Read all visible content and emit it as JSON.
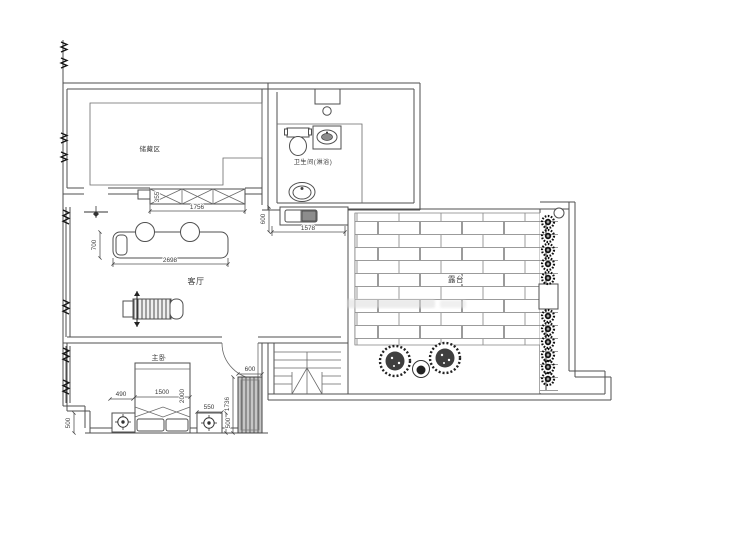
{
  "rooms": {
    "storage": "储藏区",
    "bathroom": "卫生间(淋浴)",
    "living_room": "客厅",
    "terrace": "露台",
    "master_bedroom": "主卧"
  },
  "dims": {
    "cabinet_depth": "355",
    "cabinet_width": "1756",
    "sofa_depth": "700",
    "sofa_length": "2698",
    "counter_depth": "600",
    "counter_length": "1578",
    "left_nightstand_width": "490",
    "left_nightstand_depth": "500",
    "bed_width": "1500",
    "bed_length": "2000",
    "right_nightstand_width": "550",
    "right_nightstand_depth": "500",
    "wardrobe_width": "600",
    "wardrobe_depth": "1736"
  },
  "colors": {
    "wall_line": "#4f4f4f",
    "brick_line": "#9b9b9b",
    "dark_fill": "#3f3f3f",
    "counter_fill": "#8d8d8d",
    "background": "#ffffff"
  }
}
